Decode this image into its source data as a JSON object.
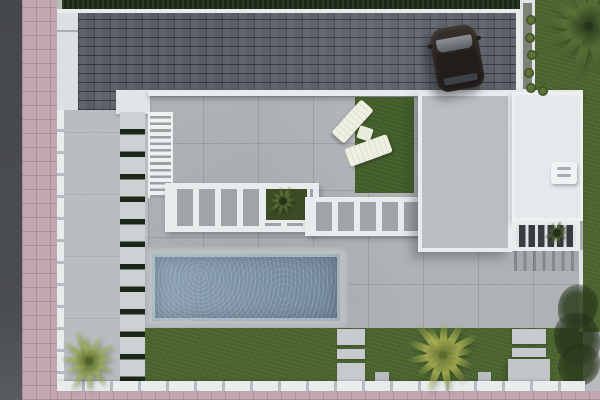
{
  "scene": {
    "type": "top-down-3d-architectural-render",
    "description": "Aerial plan view of a modern villa plot with dark paver driveway, parked car, flat roofs, pergolas, sun loungers, swimming pool, lawns, palm trees, stepping-stone path, perimeter wall, pink tiled sidewalk and asphalt road",
    "inventory": [
      "road",
      "pink-sidewalk",
      "perimeter-wall",
      "boundary-hedge",
      "paver-driveway",
      "parked-car",
      "entry-walkway",
      "stepping-stone-path",
      "staircase",
      "concrete-terrace",
      "beam-pergola",
      "pergola-planter",
      "sun-lounger",
      "side-table",
      "lounge-lawn",
      "flat-roof-gray",
      "flat-roof-white",
      "roof-hatch",
      "slatted-pergola",
      "swimming-pool",
      "pool-deck",
      "back-lawn",
      "concrete-pads",
      "garden-bush",
      "palm-trees",
      "planter-shrubs"
    ],
    "palette": {
      "road": "#47494d",
      "sidewalk": "#c1a7ae",
      "concrete": "#b6babd",
      "terrace": "#adb1b4",
      "driveway": "#585d65",
      "white": "#e9eced",
      "roof_gray": "#bcc0c3",
      "roof_white": "#e5e8ea",
      "hedge": "#1c2817",
      "grass": "#4c6630",
      "pool_water": "#8197ab",
      "lounger": "#eef0e2",
      "car_body": "#2f2a25",
      "car_glass": "#70767c"
    },
    "palms": [
      {
        "name": "palm-top-right",
        "cx": 589,
        "cy": 26,
        "size": 56,
        "leaves": 14,
        "colors": [
          "#24351a",
          "#5a7238"
        ]
      },
      {
        "name": "palm-bottom-left",
        "cx": 89,
        "cy": 361,
        "size": 37,
        "leaves": 12,
        "colors": [
          "#4f6229",
          "#9cab5c"
        ]
      },
      {
        "name": "palm-bottom-center",
        "cx": 443,
        "cy": 355,
        "size": 43,
        "leaves": 13,
        "colors": [
          "#5d6c2f",
          "#a9b053"
        ]
      },
      {
        "name": "pergola-planter-palm",
        "cx": 283,
        "cy": 201,
        "size": 18,
        "leaves": 10,
        "colors": [
          "#26351a",
          "#607339"
        ]
      },
      {
        "name": "patio-pergola-plant",
        "cx": 557,
        "cy": 233,
        "size": 15,
        "leaves": 9,
        "colors": [
          "#22311a",
          "#4c6130"
        ]
      }
    ],
    "shrubs": [
      {
        "x": 526,
        "y": 15
      },
      {
        "x": 525,
        "y": 33
      },
      {
        "x": 527,
        "y": 50
      },
      {
        "x": 524,
        "y": 68
      },
      {
        "x": 526,
        "y": 83
      },
      {
        "x": 538,
        "y": 86
      }
    ]
  }
}
